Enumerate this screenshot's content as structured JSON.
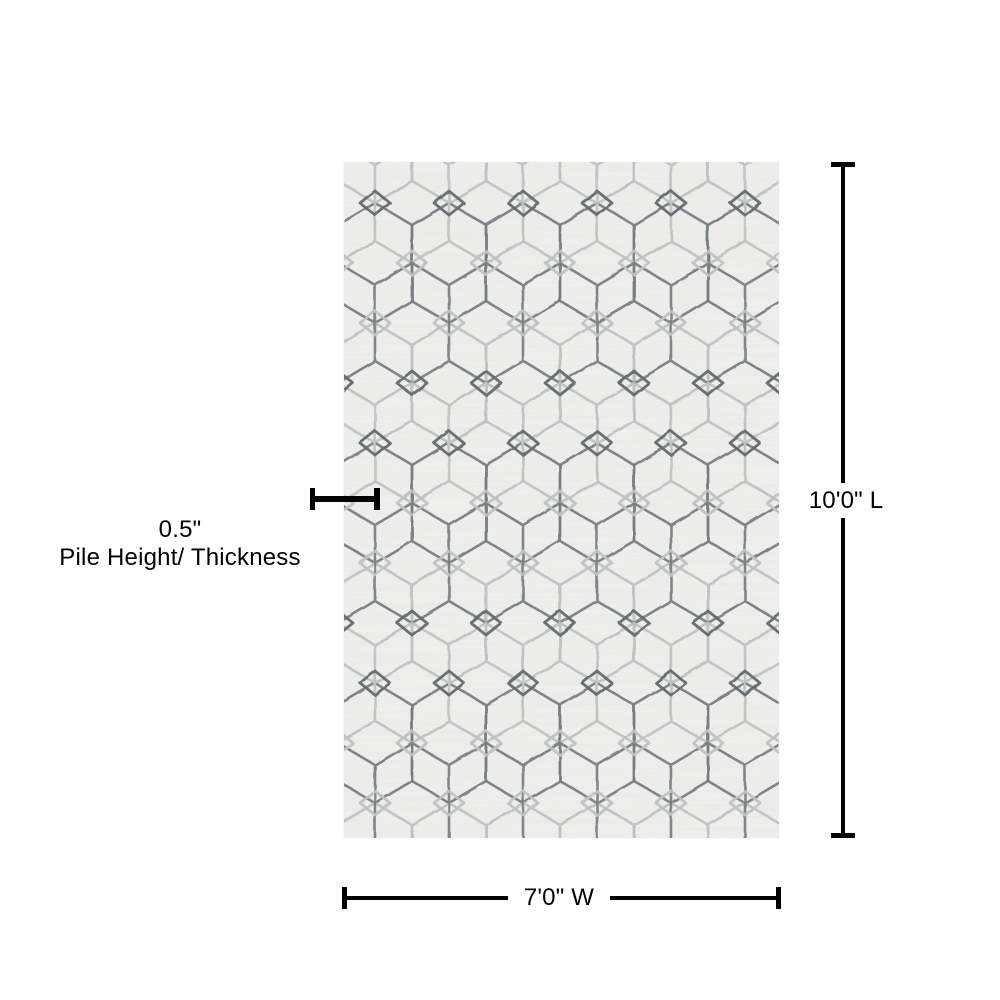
{
  "theme": {
    "canvas-bg": "#ffffff",
    "ink": "#000000",
    "rug-base": "#f0f0ee",
    "rug-dark-line": "#70767a",
    "rug-dark-accent": "#5d6367",
    "rug-light-line": "#bcc0bf"
  },
  "rug": {
    "description": "ivory and gray geometric hexagon trellis area rug",
    "pattern": "hexagon-trellis-with-diamonds"
  },
  "annotations": {
    "length": {
      "value": "10'0\"",
      "dimension": "L",
      "label": "10'0\" L"
    },
    "width": {
      "value": "7'0\"",
      "dimension": "W",
      "label": "7'0\" W"
    },
    "pile": {
      "value": "0.5\"",
      "label": "Pile Height/ Thickness"
    }
  }
}
